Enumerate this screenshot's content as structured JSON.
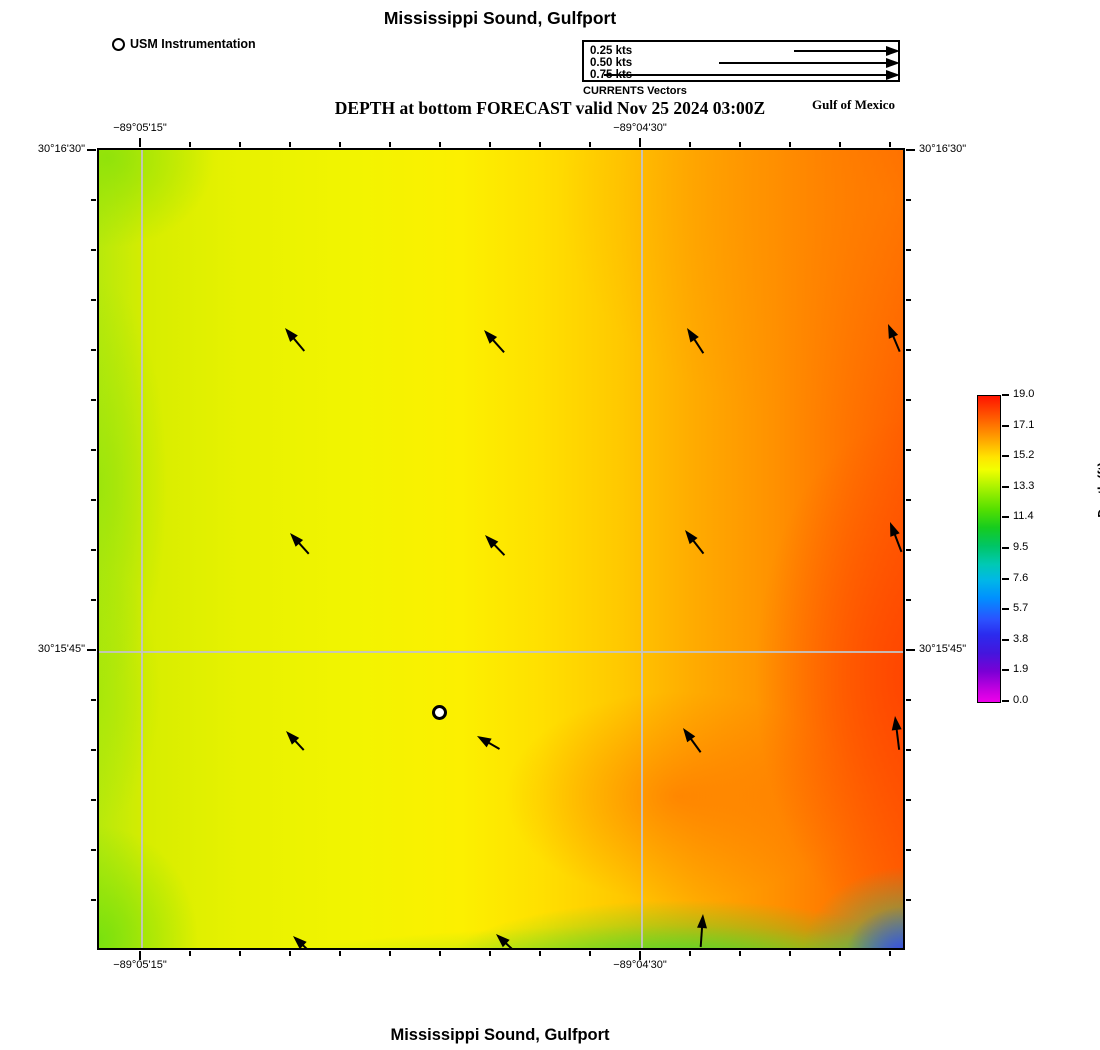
{
  "titles": {
    "top": "Mississippi Sound, Gulfport",
    "subtitle": "DEPTH at bottom FORECAST valid Nov 25 2024 03:00Z",
    "bottom": "Mississippi Sound, Gulfport",
    "region_label": "Gulf of Mexico"
  },
  "instrument_legend": {
    "label": "USM Instrumentation"
  },
  "vector_legend": {
    "caption": "CURRENTS Vectors",
    "items": [
      {
        "label": "0.25 kts",
        "shaft_px": 92
      },
      {
        "label": "0.50 kts",
        "shaft_px": 167
      },
      {
        "label": "0.75 kts",
        "shaft_px": 282
      }
    ]
  },
  "axes": {
    "top": [
      {
        "label": "−89°05'15\"",
        "x": 43
      },
      {
        "label": "−89°04'30\"",
        "x": 543
      }
    ],
    "bottom": [
      {
        "label": "−89°05'15\"",
        "x": 43
      },
      {
        "label": "−89°04'30\"",
        "x": 543
      }
    ],
    "left": [
      {
        "label": "30°16'30\"",
        "y": 2
      },
      {
        "label": "30°15'45\"",
        "y": 502
      }
    ],
    "right": [
      {
        "label": "30°16'30\"",
        "y": 2
      },
      {
        "label": "30°15'45\"",
        "y": 502
      }
    ]
  },
  "colorbar": {
    "label": "Depth (ft)",
    "ticks": [
      "19.0",
      "17.1",
      "15.2",
      "13.3",
      "11.4",
      "9.5",
      "7.6",
      "5.7",
      "3.8",
      "1.9",
      "0.0"
    ]
  },
  "map": {
    "marker": {
      "x": 340,
      "y": 562
    },
    "arrows": [
      {
        "x": 186,
        "y": 178,
        "deg": -40,
        "len": 30
      },
      {
        "x": 385,
        "y": 180,
        "deg": -42,
        "len": 30
      },
      {
        "x": 588,
        "y": 178,
        "deg": -33,
        "len": 30
      },
      {
        "x": 789,
        "y": 174,
        "deg": -23,
        "len": 30
      },
      {
        "x": 191,
        "y": 383,
        "deg": -42,
        "len": 28
      },
      {
        "x": 386,
        "y": 385,
        "deg": -44,
        "len": 28
      },
      {
        "x": 586,
        "y": 380,
        "deg": -38,
        "len": 30
      },
      {
        "x": 791,
        "y": 372,
        "deg": -21,
        "len": 32
      },
      {
        "x": 187,
        "y": 581,
        "deg": -43,
        "len": 26
      },
      {
        "x": 378,
        "y": 586,
        "deg": -60,
        "len": 26
      },
      {
        "x": 584,
        "y": 578,
        "deg": -36,
        "len": 30
      },
      {
        "x": 796,
        "y": 566,
        "deg": -7,
        "len": 34
      },
      {
        "x": 194,
        "y": 786,
        "deg": -47,
        "len": 26
      },
      {
        "x": 397,
        "y": 784,
        "deg": -47,
        "len": 26
      },
      {
        "x": 604,
        "y": 764,
        "deg": 4,
        "len": 33
      }
    ]
  },
  "colors": {
    "deep_red": "#ff1400",
    "orange": "#ffa200",
    "yellow": "#f2f400",
    "yellow_green": "#b8e90c",
    "green": "#16cc1e",
    "cyan": "#00b8e6",
    "blue": "#2b2bee",
    "magenta": "#ee00ea",
    "gridline": "#c3c3c3",
    "arrow": "#000000"
  },
  "chart_data": {
    "type": "heatmap",
    "title": "Mississippi Sound, Gulfport",
    "subtitle": "DEPTH at bottom FORECAST valid Nov 25 2024 03:00Z",
    "region": "Gulf of Mexico",
    "xlabel_ticks": [
      "−89°05'15\"",
      "−89°04'30\""
    ],
    "ylabel_ticks": [
      "30°16'30\"",
      "30°15'45\""
    ],
    "colorbar_label": "Depth (ft)",
    "colorbar_ticks": [
      19.0,
      17.1,
      15.2,
      13.3,
      11.4,
      9.5,
      7.6,
      5.7,
      3.8,
      1.9,
      0.0
    ],
    "value_range_ft": [
      0.0,
      19.0
    ],
    "field_summary": "Depth ~13-15 ft (yellow-green) in the west, deepening eastward to ~17-19 ft (orange-red) along the east edge; shallow band ~11-13 ft (green) along the south edge with a ~2-5 ft (blue) patch in the southeast corner.",
    "current_vectors": {
      "legend_speeds_kts": [
        0.25,
        0.5,
        0.75
      ],
      "grid": "4x4 plus bottom row",
      "predominant_direction": "northwest, weak"
    },
    "instrument_site": {
      "label": "USM Instrumentation",
      "approx_lon": "−89°04'45\"",
      "approx_lat": "30°15'42\""
    }
  }
}
